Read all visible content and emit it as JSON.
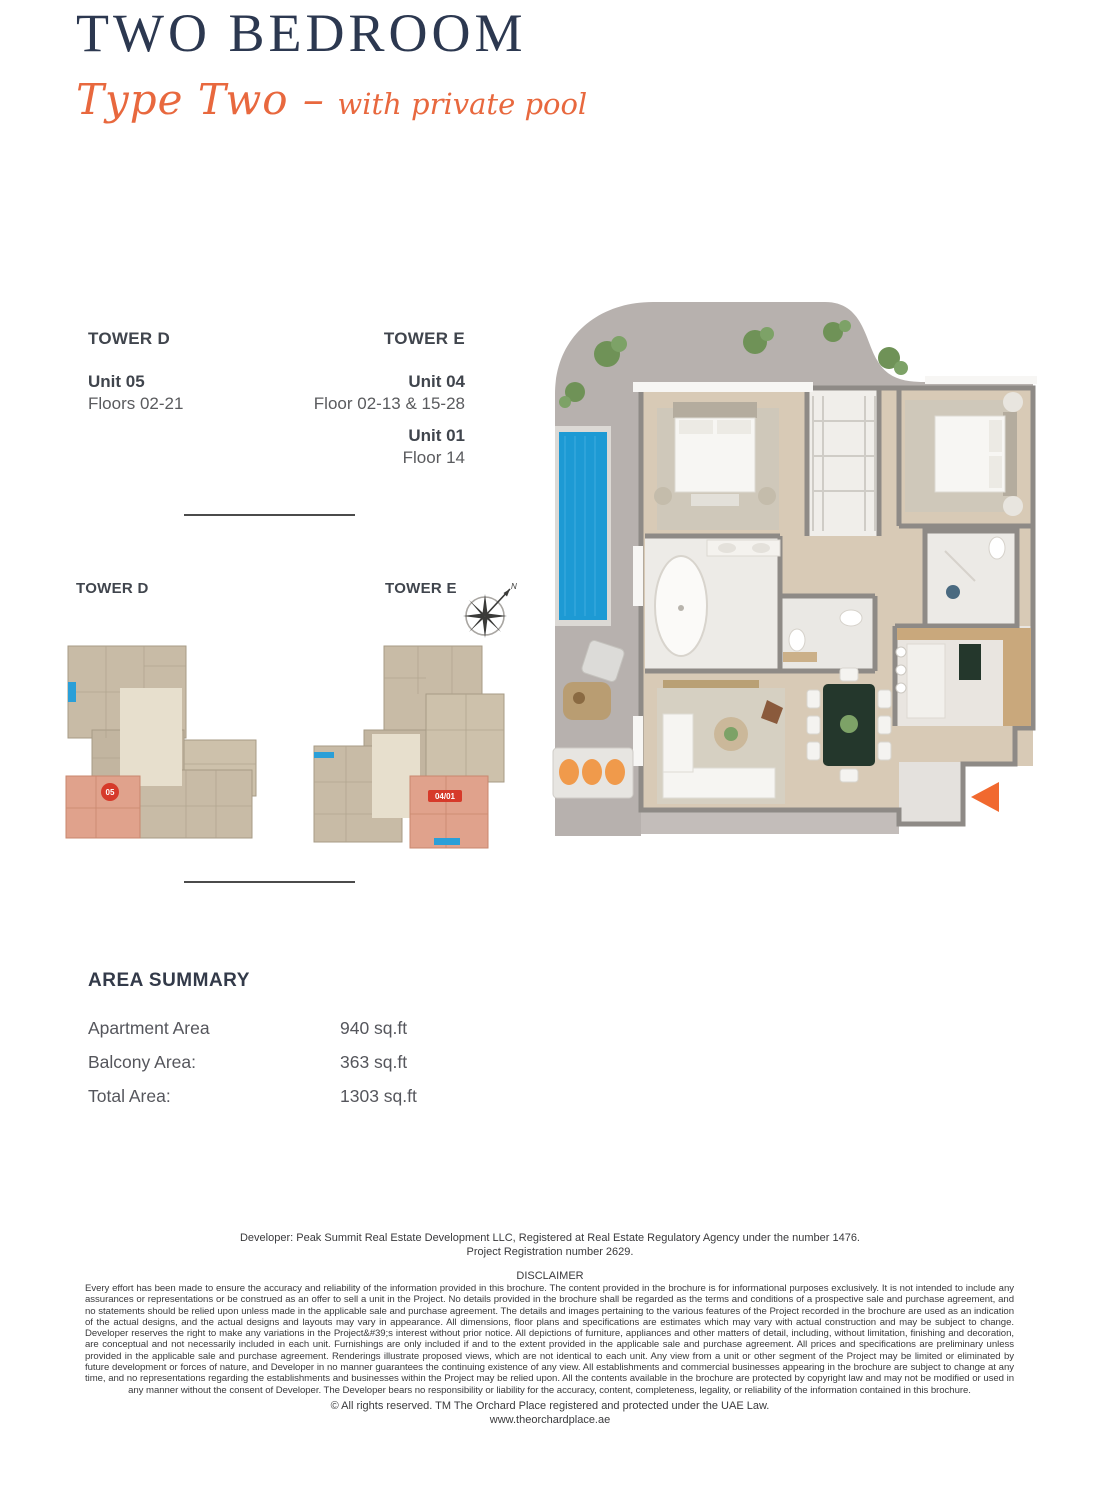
{
  "page": {
    "title": "TWO BEDROOM",
    "subtitle_script": "Type Two –",
    "subtitle_rest": "with private pool"
  },
  "unit_info": {
    "tower_d": {
      "name": "TOWER D",
      "units": [
        {
          "unit": "Unit 05",
          "floors": "Floors 02-21"
        }
      ]
    },
    "tower_e": {
      "name": "TOWER E",
      "units": [
        {
          "unit": "Unit 04",
          "floors": "Floor 02-13 & 15-28"
        },
        {
          "unit": "Unit 01",
          "floors": "Floor 14"
        }
      ]
    }
  },
  "key_plans": {
    "tower_d_label": "TOWER D",
    "tower_e_label": "TOWER E",
    "tower_d_unit_badge": "05",
    "tower_e_unit_badge": "04/01",
    "compass_north_label": "N"
  },
  "area_summary": {
    "heading": "AREA SUMMARY",
    "rows": [
      {
        "label": "Apartment Area",
        "value": "940 sq.ft"
      },
      {
        "label": "Balcony Area:",
        "value": "363 sq.ft"
      },
      {
        "label": "Total Area:",
        "value": "1303 sq.ft"
      }
    ]
  },
  "footer": {
    "developer_line1": "Developer: Peak Summit Real Estate Development LLC, Registered at Real Estate Regulatory Agency under the number 1476.",
    "developer_line2": "Project Registration number 2629.",
    "disclaimer_heading": "DISCLAIMER",
    "disclaimer_body": "Every effort has been made to ensure the accuracy and reliability of the information provided in this brochure. The content provided in the brochure is for informational purposes exclusively. It is not intended to include any assurances or representations or be construed as an offer to sell a unit in the Project. No details provided in the brochure shall be regarded as the terms and conditions of a prospective sale and purchase agreement, and no statements should be relied upon unless made in the applicable sale and purchase agreement. The details and images pertaining to the various features of the Project recorded in the brochure are used as an indication of the actual designs, and the actual designs and layouts may vary in appearance. All dimensions, floor plans and specifications are estimates which may vary with actual construction and may be subject to change. Developer reserves the right to make any variations in the Project&#39;s interest without prior notice. All depictions of furniture, appliances and other matters of detail, including, without limitation, finishing and decoration, are conceptual and not necessarily included in each unit. Furnishings are only included if and to the extent provided in the applicable sale and purchase agreement. All prices and specifications are preliminary unless provided in the applicable sale and purchase agreement. Renderings illustrate proposed views, which are not identical to each unit. Any view from a unit or other segment of the Project may be limited or eliminated by future development or forces of nature, and Developer in no manner guarantees the continuing existence of any view. All establishments and commercial businesses appearing in the brochure are subject to change at any time, and no representations regarding the establishments and businesses within the Project may be relied upon. All the contents available in the brochure are protected by copyright law and may not be modified or used in any manner without the consent of Developer. The Developer bears no responsibility or liability for the accuracy, content, completeness, legality, or reliability of the information contained in this brochure.",
    "rights_line": "©  All rights reserved.  TM  The Orchard Place registered and protected under the UAE Law.",
    "website": "www.theorchardplace.ae"
  },
  "colors": {
    "navy_title": "#2c3850",
    "accent_orange": "#e8683e",
    "entry_arrow_orange": "#f1692f",
    "pool_blue": "#1d9ad4",
    "badge_red": "#d63a2a",
    "highlight_unit": "#e0a28c",
    "terrace_gray": "#b7b1ae",
    "floor_beige": "#d8cab6"
  }
}
